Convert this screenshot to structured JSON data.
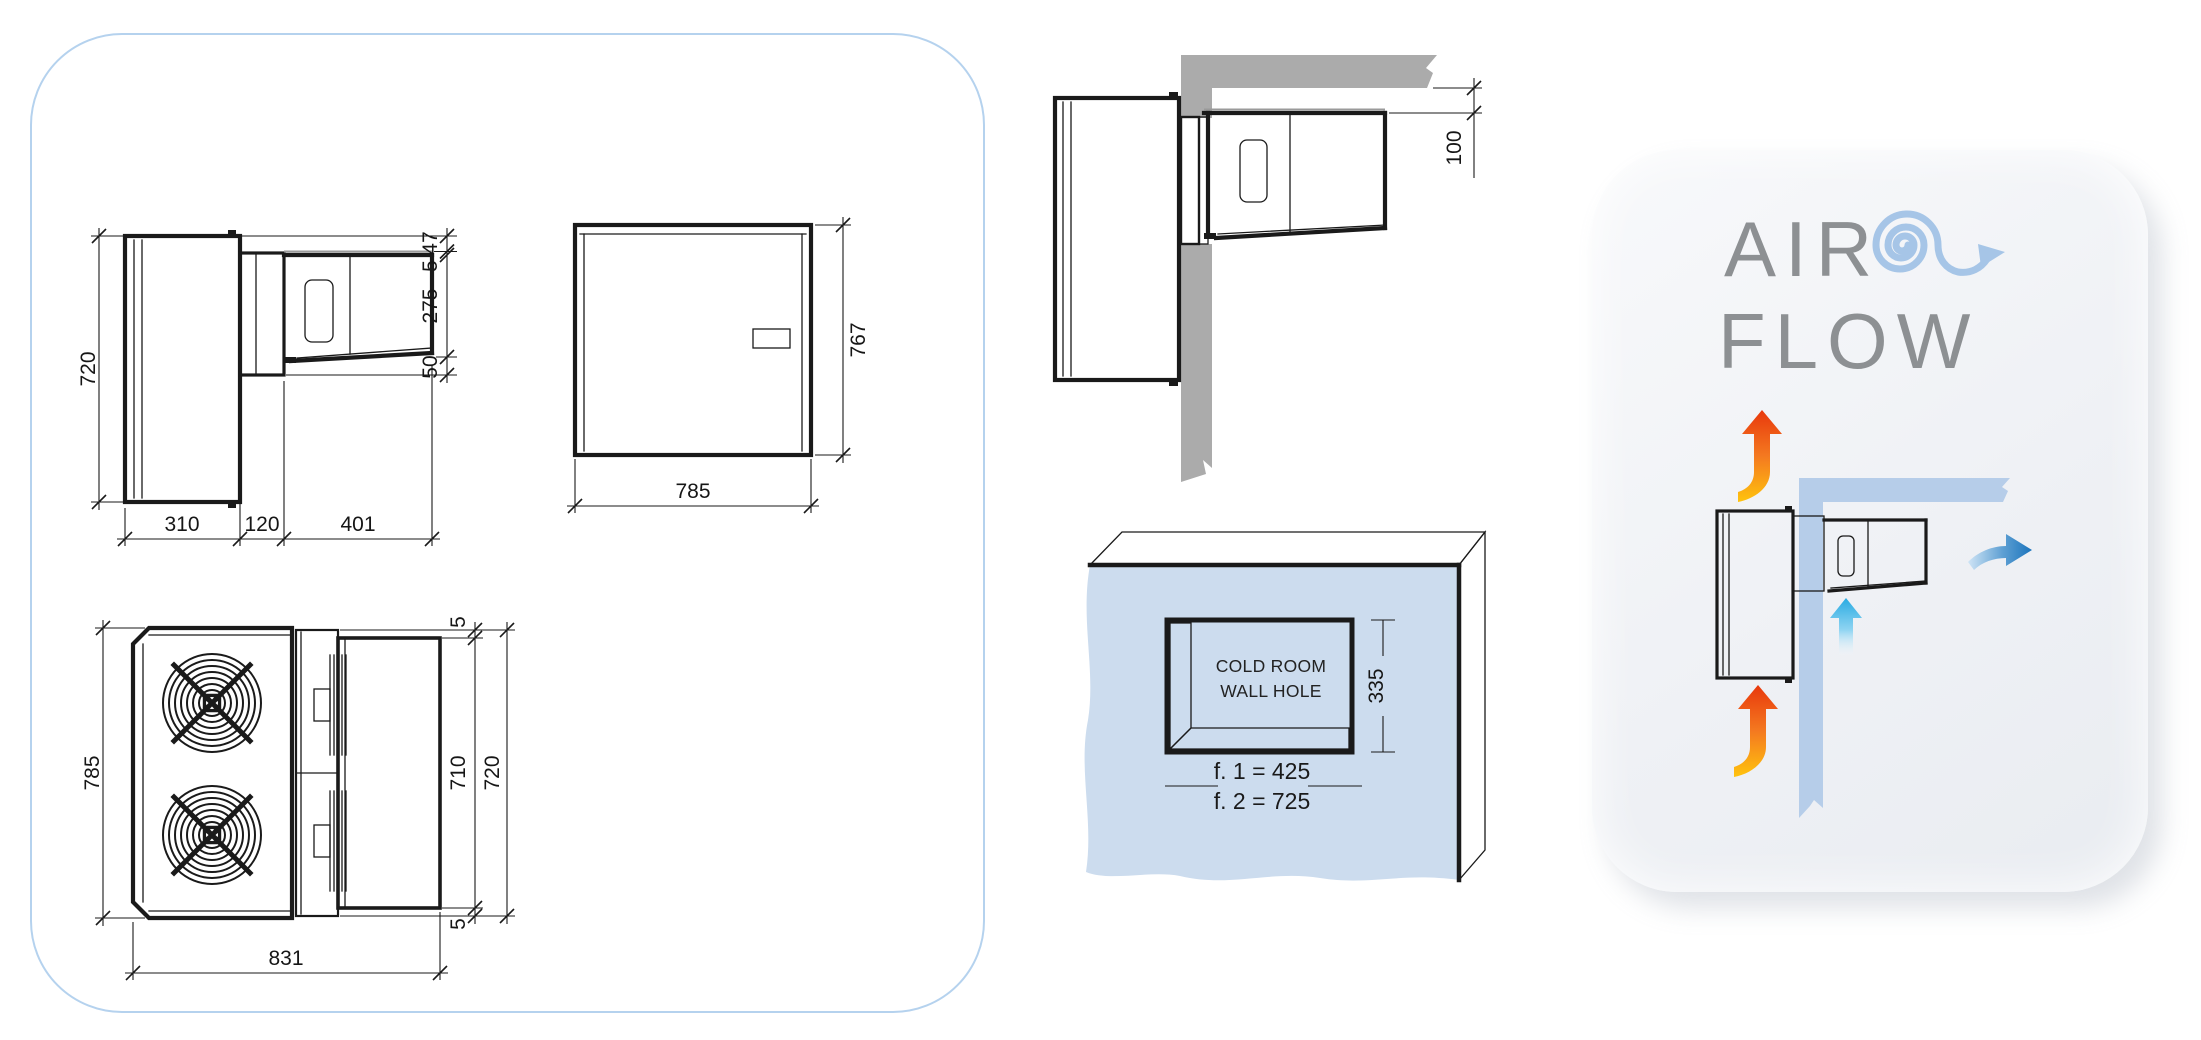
{
  "colors": {
    "panel_border": "#b5d2ee",
    "gasket_yellow": "#ffd400",
    "wall_gray": "#ababab",
    "coldroom_wall_blue": "#ccdcee",
    "hole_bevel_gray": "#b5b5b5",
    "roof_gray": "#c7c7c7",
    "side_face_gray": "#b0b0b0",
    "airflow_wall_blue": "#b6cde9",
    "hot_arrow_red": "#e8380c",
    "hot_arrow_orange": "#f47920",
    "hot_arrow_yellow": "#ffc30e",
    "cold_arrow_cyan": "#29abe2",
    "supply_arrow_blue": "#1b74bc",
    "spiral_blue": "#a6c5e7",
    "title_gray": "#8d9093",
    "line_black": "#1a1a1a"
  },
  "side_view": {
    "height": "720",
    "condenser_depth": "310",
    "wall_thickness": "120",
    "evaporator_depth": "401",
    "top_offset": "47",
    "flange_gap": "5",
    "evaporator_height": "275",
    "bottom_clearance": "50"
  },
  "front_view": {
    "width": "785",
    "height": "767"
  },
  "top_view": {
    "depth": "785",
    "overall_width": "831",
    "top_gap": "5",
    "evaporator_width": "710",
    "body_width": "720",
    "bottom_gap": "5"
  },
  "wall_section": {
    "ceiling_clearance": "100"
  },
  "wall_hole": {
    "label_line1": "COLD ROOM",
    "label_line2": "WALL HOLE",
    "hole_height": "335",
    "hole_width_f1": "f. 1 = 425",
    "hole_width_f2": "f. 2 = 725"
  },
  "airflow": {
    "title_line1": "AIR",
    "title_line2": "FLOW"
  }
}
